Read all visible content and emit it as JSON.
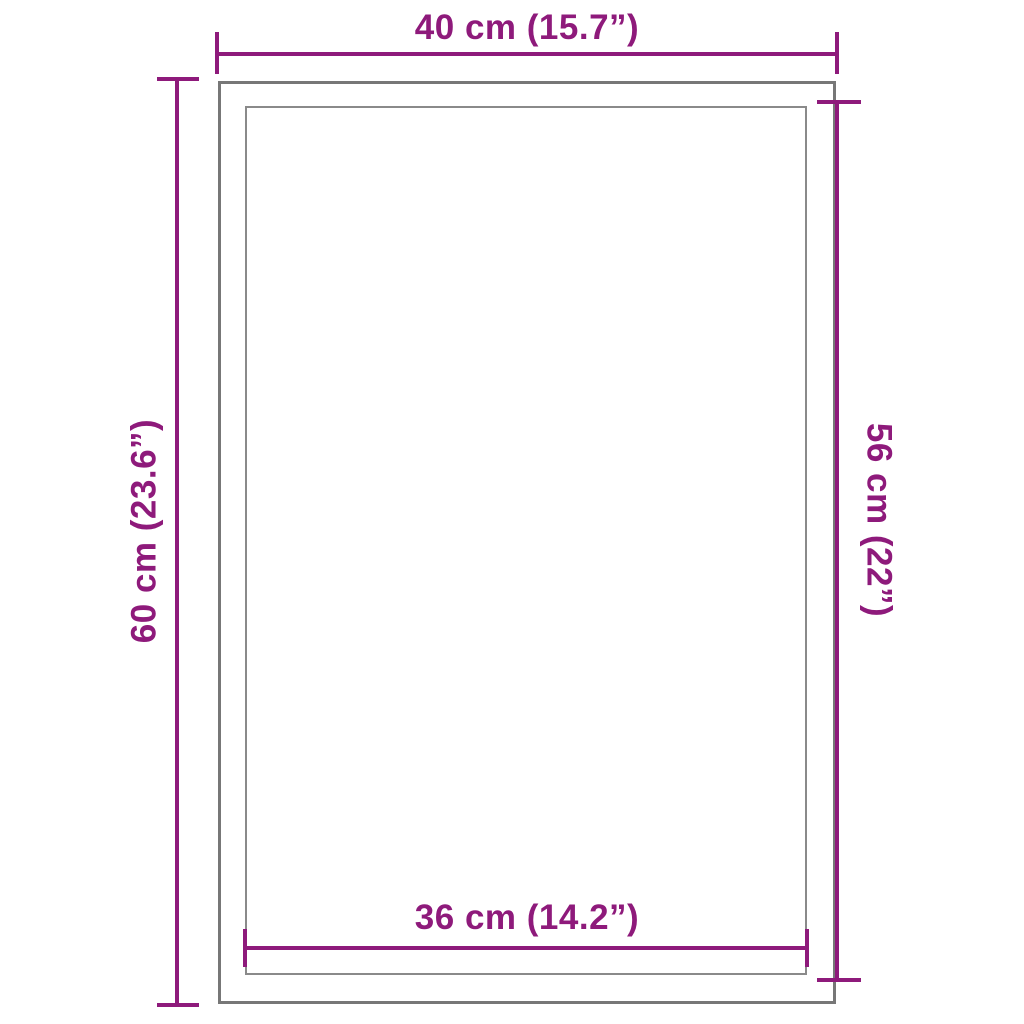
{
  "diagram": {
    "kind": "product-dimension-drawing",
    "colors": {
      "accent": "#8E1A7B",
      "outline": "#777777",
      "outline_light": "#8A8A8A",
      "background": "#FFFFFF"
    },
    "frames": {
      "outer": "outer-frame",
      "inner": "inner-frame"
    },
    "dimensions": {
      "top": {
        "label": "40 cm (15.7”)",
        "orientation": "horizontal",
        "measures": "outer-width"
      },
      "left": {
        "label": "60 cm (23.6”)",
        "orientation": "vertical",
        "measures": "outer-height"
      },
      "right": {
        "label": "56 cm (22”)",
        "orientation": "vertical",
        "measures": "inner-height"
      },
      "bottom": {
        "label": "36 cm (14.2”)",
        "orientation": "horizontal",
        "measures": "inner-width"
      }
    }
  }
}
